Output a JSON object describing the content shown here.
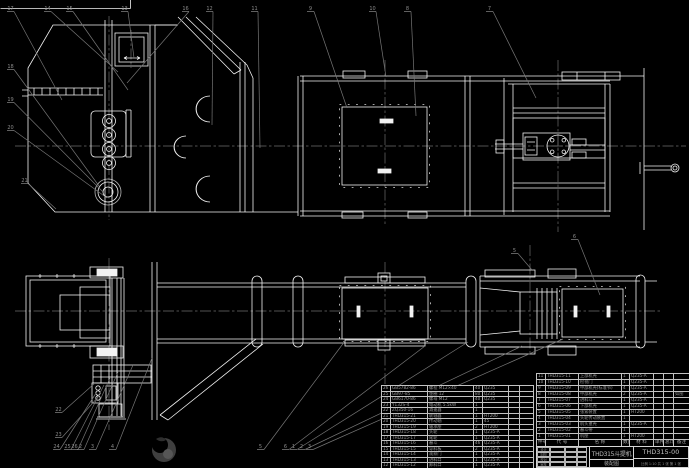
{
  "colors": {
    "background": "#000000",
    "line": "#f2f2f2",
    "dim_line": "#777777",
    "table_line": "#c2c2c2",
    "text": "#9a9a9a",
    "watermark": "#3f3f3f"
  },
  "titleblock": {
    "product": "THD315斗提机",
    "doc_type": "装配图",
    "drawing_no": "THD315-00",
    "extra": "比例 1:10  共 1 张  第 1 张",
    "sign_rows": [
      "设计",
      "制图",
      "校对",
      "审核"
    ]
  },
  "bom_right": {
    "headers": [
      "件号",
      "代  号",
      "名  称",
      "数量",
      "材  料",
      "单件",
      "总计",
      "备注"
    ],
    "rows": [
      [
        "11",
        "THD315-11",
        "上部机壳",
        "1",
        "Q235-A",
        "",
        "",
        ""
      ],
      [
        "10",
        "THD315-10",
        "检视门",
        "1",
        "Q235-A",
        "",
        "",
        ""
      ],
      [
        "9",
        "THD315-09",
        "中部机壳(标准节)",
        "4",
        "Q235-A",
        "",
        "",
        ""
      ],
      [
        "8",
        "THD315-08",
        "中部机壳",
        "2",
        "Q235-A",
        "",
        "",
        "如图"
      ],
      [
        "7",
        "THD315-07",
        "进料斗",
        "1",
        "Q235-A",
        "",
        "",
        ""
      ],
      [
        "6",
        "THD315-06",
        "下部机壳",
        "1",
        "Q235-A",
        "",
        "",
        ""
      ],
      [
        "5",
        "THD315-05",
        "张紧装置",
        "1",
        "HT200",
        "",
        "",
        ""
      ],
      [
        "4",
        "THD315-04",
        "头轮传动装置",
        "1",
        "",
        "",
        "",
        ""
      ],
      [
        "3",
        "THD315-03",
        "机头罩壳",
        "1",
        "Q235-A",
        "",
        "",
        ""
      ],
      [
        "2",
        "THD315-02",
        "畚斗带",
        "1",
        "",
        "",
        "",
        ""
      ],
      [
        "1",
        "THD315-01",
        "机座",
        "1",
        "HT200",
        "",
        "",
        ""
      ]
    ]
  },
  "bom_left": {
    "rows": [
      [
        "26",
        "GB5782-86",
        "螺栓 M12×40",
        "40",
        "Q235",
        "",
        ""
      ],
      [
        "25",
        "GB97-85",
        "垫圈 12",
        "80",
        "Q235",
        "",
        ""
      ],
      [
        "24",
        "GB6170-86",
        "螺母 M12",
        "40",
        "Q235",
        "",
        ""
      ],
      [
        "23",
        "Y132S-4",
        "电动机 5.5kW",
        "1",
        "",
        "",
        ""
      ],
      [
        "22",
        "ZQ350-16",
        "减速器",
        "1",
        "",
        "",
        ""
      ],
      [
        "21",
        "THD315-21",
        "联轴器",
        "1",
        "HT200",
        "",
        ""
      ],
      [
        "20",
        "THD315-20",
        "传动轴",
        "1",
        "45",
        "",
        ""
      ],
      [
        "19",
        "THD315-19",
        "轴承座",
        "2",
        "HT200",
        "",
        ""
      ],
      [
        "18",
        "THD315-18",
        "头轮",
        "1",
        "Q235-A",
        "",
        ""
      ],
      [
        "17",
        "THD315-17",
        "尾轮",
        "1",
        "Q235-A",
        "",
        ""
      ],
      [
        "16",
        "THD315-16",
        "畚斗",
        "46",
        "Q235-A",
        "",
        ""
      ],
      [
        "15",
        "THD315-15",
        "导料板",
        "2",
        "Q235-A",
        "",
        ""
      ],
      [
        "14",
        "THD315-14",
        "观察门",
        "1",
        "Q235-A",
        "",
        ""
      ],
      [
        "13",
        "THD315-13",
        "进料口",
        "1",
        "Q235-A",
        "",
        ""
      ],
      [
        "12",
        "THD315-12",
        "卸料口",
        "1",
        "Q235-A",
        "",
        ""
      ]
    ]
  },
  "callouts": [
    {
      "label": "17",
      "x": 8,
      "y": 10,
      "ex": 62,
      "ey": 100
    },
    {
      "label": "14",
      "x": 45,
      "y": 10,
      "ex": 118,
      "ey": 72
    },
    {
      "label": "15",
      "x": 67,
      "y": 10,
      "ex": 128,
      "ey": 90
    },
    {
      "label": "13",
      "x": 122,
      "y": 10,
      "ex": 134,
      "ey": 58
    },
    {
      "label": "16",
      "x": 183,
      "y": 10,
      "ex": 127,
      "ey": 83
    },
    {
      "label": "12",
      "x": 207,
      "y": 10,
      "ex": 212,
      "ey": 125
    },
    {
      "label": "11",
      "x": 252,
      "y": 10,
      "ex": 260,
      "ey": 148
    },
    {
      "label": "9",
      "x": 308,
      "y": 10,
      "ex": 347,
      "ey": 108
    },
    {
      "label": "10",
      "x": 370,
      "y": 10,
      "ex": 386,
      "ey": 77
    },
    {
      "label": "8",
      "x": 405,
      "y": 10,
      "ex": 416,
      "ey": 116
    },
    {
      "label": "7",
      "x": 487,
      "y": 10,
      "ex": 536,
      "ey": 98
    },
    {
      "label": "18",
      "x": 8,
      "y": 68,
      "ex": 99,
      "ey": 186
    },
    {
      "label": "19",
      "x": 8,
      "y": 101,
      "ex": 103,
      "ey": 192
    },
    {
      "label": "20",
      "x": 8,
      "y": 129,
      "ex": 107,
      "ey": 198
    },
    {
      "label": "21",
      "x": 22,
      "y": 182,
      "ex": 56,
      "ey": 209
    },
    {
      "label": "22",
      "x": 56,
      "y": 411,
      "ex": 95,
      "ey": 383
    },
    {
      "label": "23",
      "x": 56,
      "y": 436,
      "ex": 99,
      "ey": 396
    },
    {
      "label": "24",
      "x": 54,
      "y": 448,
      "ex": 98,
      "ey": 390
    },
    {
      "label": "25",
      "x": 65,
      "y": 448,
      "ex": 104,
      "ey": 385
    },
    {
      "label": "26",
      "x": 72,
      "y": 448,
      "ex": 110,
      "ey": 378
    },
    {
      "label": "2",
      "x": 78,
      "y": 448,
      "ex": 118,
      "ey": 372
    },
    {
      "label": "3",
      "x": 90,
      "y": 448,
      "ex": 133,
      "ey": 365
    },
    {
      "label": "4",
      "x": 110,
      "y": 448,
      "ex": 152,
      "ey": 358
    },
    {
      "label": "5",
      "x": 258,
      "y": 448,
      "ex": 345,
      "ey": 341
    },
    {
      "label": "6",
      "x": 283,
      "y": 448,
      "ex": 425,
      "ey": 346
    },
    {
      "label": "1",
      "x": 291,
      "y": 448,
      "ex": 468,
      "ey": 342
    },
    {
      "label": "2",
      "x": 299,
      "y": 448,
      "ex": 522,
      "ey": 346
    },
    {
      "label": "3",
      "x": 307,
      "y": 448,
      "ex": 563,
      "ey": 339
    },
    {
      "label": "6",
      "x": 572,
      "y": 238,
      "ex": 600,
      "ey": 295
    },
    {
      "label": "5",
      "x": 512,
      "y": 252,
      "ex": 532,
      "ey": 270
    }
  ]
}
